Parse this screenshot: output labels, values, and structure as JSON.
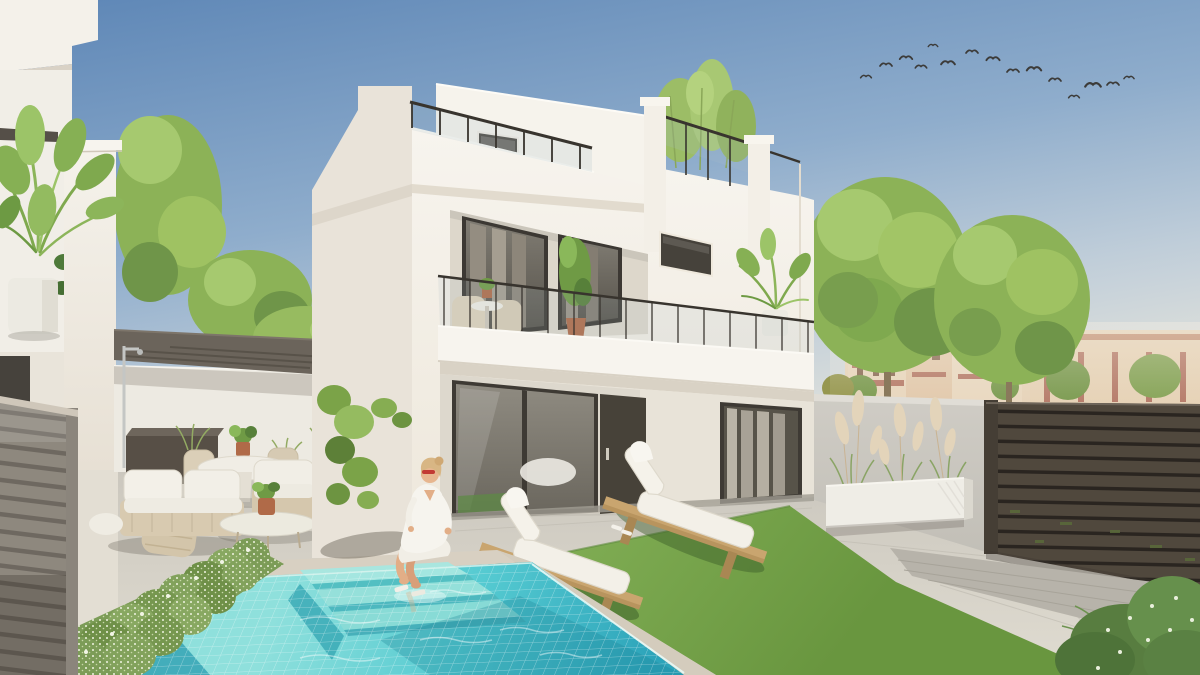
{
  "image": {
    "title": "New-build modern villa with private pool — exterior architectural render",
    "width": 1200,
    "height": 675
  },
  "scene": {
    "setting": "Two-storey white render villa with roof terrace, glass balustrades, first-floor balcony, ground-floor sliding doors, private mosaic pool and landscaped patio under a clear sky",
    "sky": "clear blue sky fading to warm haze at the horizon, flock of birds upper right",
    "main_house": "white villa with roof terrace glass railing, small dark window, balcony with bistro set and potted plants, dark entry door and two dark-framed sliding glass doors",
    "left_building": "neighbouring white house with potted palm on ledge and grey slatted fence",
    "pergola": "dark flat pergola over corner lounge area",
    "outdoor_lounge": "beige rope-weave sofa set with white cushions, oval coffee table, round dining table with chairs, dark storage bench, pool shower",
    "pool": "turquoise mosaic-tiled pool with three wide underwater steps and beige coping",
    "woman": "woman in white shirt dress, blonde hair and red sunglasses sitting on the pool edge",
    "sun_loungers": "two timber sun loungers with white mattresses on artificial turf",
    "right_boundary": "grey garden wall with long white trough planter of pampas grass, dark brown horizontal slatted fence",
    "background": "round green trees and terracotta Mediterranean apartment buildings",
    "bird_count": 15,
    "lounger_count": 2,
    "pool_step_count": 3
  },
  "palette": {
    "sky_top": "#5d86b6",
    "sky_upper": "#8fadcc",
    "sky_lower": "#bfcdd9",
    "sky_horizon": "#f4eddd",
    "house_bright": "#f7f4ee",
    "house_shade": "#e9e3d9",
    "house_recess": "#ddd7cb",
    "soffit": "#d9d2c5",
    "frame_dark": "#3c3833",
    "glass_dark": "#55514a",
    "curtain_gray": "#948d81",
    "sheer_curtain": "#bab4a7",
    "door_dark": "#474239",
    "railing_metal": "#38342e",
    "pergola": "#6b645b",
    "tree_green": "#8cb257",
    "tree_green_light": "#a6c96f",
    "tree_green_dark": "#6f9549",
    "palm_green": "#7fa94e",
    "distant_wall": "#e6d3b9",
    "distant_terracotta": "#b57a68",
    "distant_roof": "#c08a6e",
    "boundary_wall": "#cfccc5",
    "planter_white": "#efede6",
    "pampas": "#e3d4ba",
    "fence_dark_slat": "#50483d",
    "fence_dark_gap": "#2a2520",
    "fence_gray_slat": "#8e887e",
    "fence_gray_gap": "#6e6860",
    "patio_light": "#e0dcd1",
    "patio_back": "#c9c5bc",
    "deck_gray": "#b7b3aa",
    "coping": "#d8d0c2",
    "pool_shallow": "#8fe0dc",
    "pool_mid": "#55cad1",
    "pool_deep": "#2da4ba",
    "turf_green": "#7fac53",
    "turf_dark": "#69963f",
    "hedge_green": "#7c9c57",
    "hedge_flower": "#eef2e0",
    "lounger_wood": "#c9a56f",
    "cushion_white": "#f3f0e8",
    "sofa_beige": "#d8cab0",
    "terracotta_pot": "#b06a48",
    "skin": "#e2ae87",
    "hair_blonde": "#d8b684",
    "sunglasses_red": "#c23a33",
    "robe_white": "#f6f4ee",
    "bird": "#3c3b39"
  }
}
